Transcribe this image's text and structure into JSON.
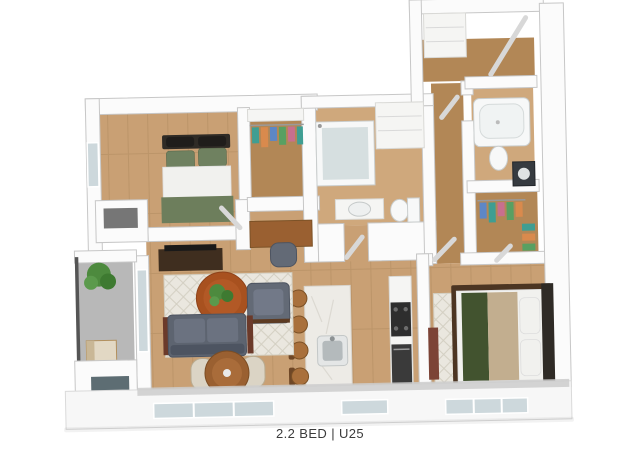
{
  "caption": {
    "text": "2.2 BED | U25"
  },
  "plan": {
    "type": "3d-apartment-floor-plan",
    "rooms": [
      "bedroom-1",
      "walk-in-closet-1",
      "bathroom-1",
      "laundry-closet",
      "entry",
      "bathroom-2",
      "walk-in-closet-2",
      "bedroom-2",
      "kitchen",
      "living-dining",
      "desk-nook",
      "balcony",
      "hall-corridor",
      "storage-closet"
    ]
  },
  "colors": {
    "wall": "#fbfbfb",
    "wall_edge": "#c7c7c7",
    "wood": "#c9a074",
    "wood_dark": "#b28756",
    "wood_light": "#cfa87c",
    "balcony_floor": "#b8b8b8",
    "rug": "#eae7df",
    "rug_line": "#d3cfc2",
    "sofa": "#5d6470",
    "sofa_light": "#6b7280",
    "sofa_dark": "#4d5461",
    "chair_gray": "#636a76",
    "table_orange": "#a8511f",
    "wood_furn": "#9a6031",
    "beige": "#dbd4c5",
    "console": "#3f2e1f",
    "marble": "#edebe6",
    "counter": "#f5f5f3",
    "appliance": "#2e2e2e",
    "fixture": "#f7f8f8",
    "fixture_edge": "#c9cdcd",
    "glass": "#d6dfe0",
    "window": "#cdd8dc",
    "bed_green": "#6f8160",
    "blanket_green": "#6d7e5c",
    "runner_green": "#42532f",
    "duvet": "#f1f1ee",
    "tan": "#c2ae8f",
    "bed_frame": "#4c3522",
    "headboard": "#2f2b26",
    "plant": "#4d8a3e",
    "caption": "#3b3b3b",
    "clothes": [
      "#3f9e92",
      "#d98a4d",
      "#5d87c6",
      "#58a062",
      "#c86f8e"
    ]
  }
}
